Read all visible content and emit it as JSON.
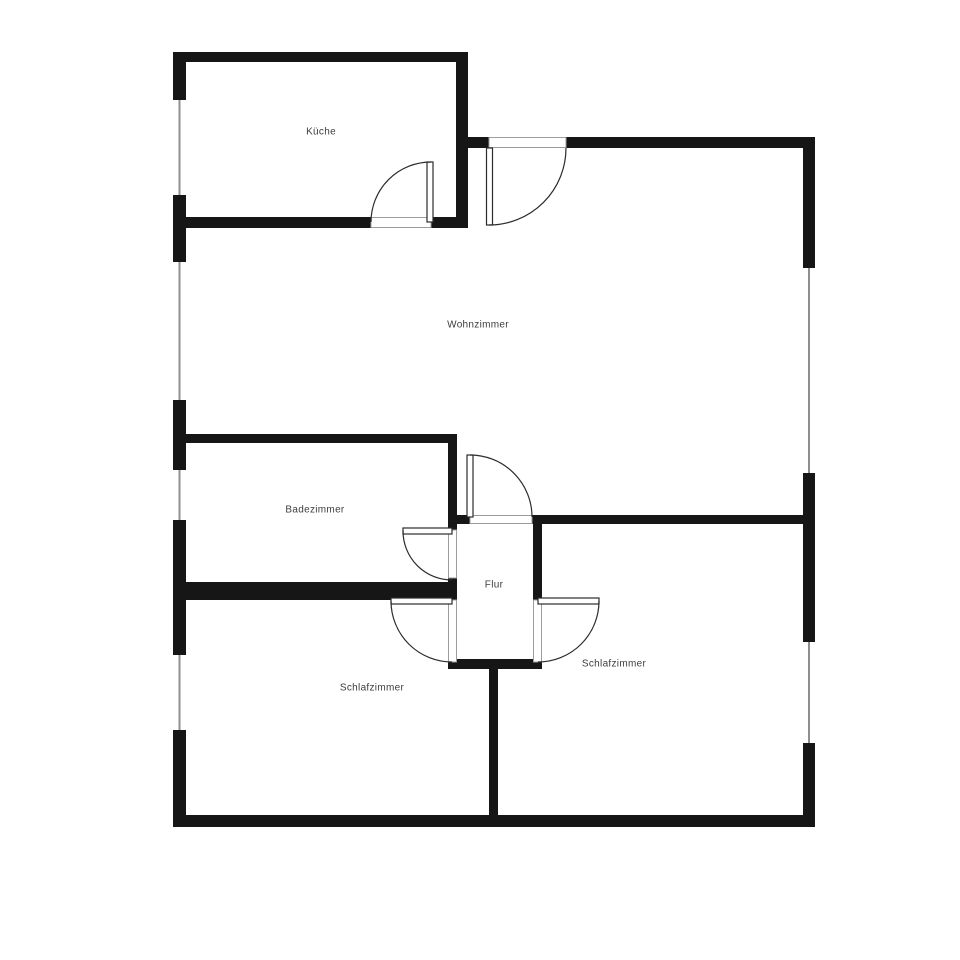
{
  "plan": {
    "rooms": {
      "kueche": {
        "label": "Küche"
      },
      "wohnzimmer": {
        "label": "Wohnzimmer"
      },
      "badezimmer": {
        "label": "Badezimmer"
      },
      "flur": {
        "label": "Flur"
      },
      "schlafzimmer_links": {
        "label": "Schlafzimmer"
      },
      "schlafzimmer_rechts": {
        "label": "Schlafzimmer"
      }
    },
    "colors": {
      "background": "#ffffff",
      "wall": "#161616",
      "label_text": "#3d3d3d",
      "window_line": "#8f8f8f",
      "door_line": "#2b2b2b",
      "door_opening_border": "#9c9c9c"
    }
  }
}
